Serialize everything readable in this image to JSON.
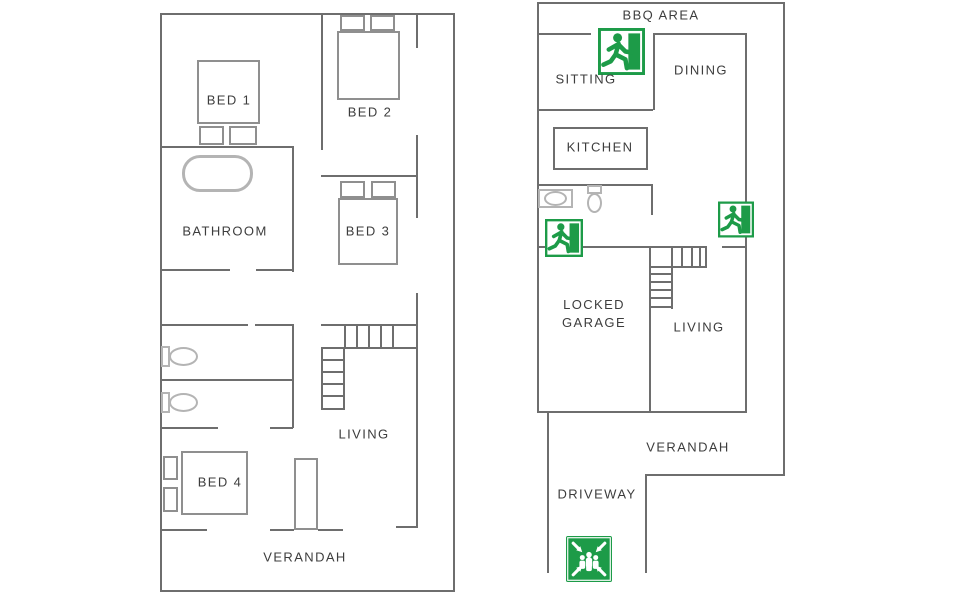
{
  "document_type": "fire-evacuation-floor-plan",
  "plans": {
    "left": {
      "labels": {
        "bed1": "BED 1",
        "bed2": "BED 2",
        "bathroom": "BATHROOM",
        "bed3": "BED 3",
        "living": "LIVING",
        "bed4": "BED 4",
        "verandah": "VERANDAH"
      }
    },
    "right": {
      "labels": {
        "bbq_area": "BBQ AREA",
        "sitting": "SITTING",
        "dining": "DINING",
        "kitchen": "KITCHEN",
        "locked_garage": "LOCKED GARAGE",
        "living": "LIVING",
        "verandah": "VERANDAH",
        "driveway": "DRIVEWAY"
      }
    }
  },
  "icons": {
    "emergency_exit_sign": "running-man-exit-icon",
    "emergency_exit_count": 3,
    "assembly_point_sign": "assembly-point-icon",
    "assembly_point_count": 1
  },
  "colors": {
    "wall": "#6e6e6e",
    "furniture": "#8f8f8f",
    "fixture": "#b4b4b4",
    "label_text": "#3d3d3d",
    "safety_green": "#1d9b48",
    "background": "#ffffff"
  }
}
